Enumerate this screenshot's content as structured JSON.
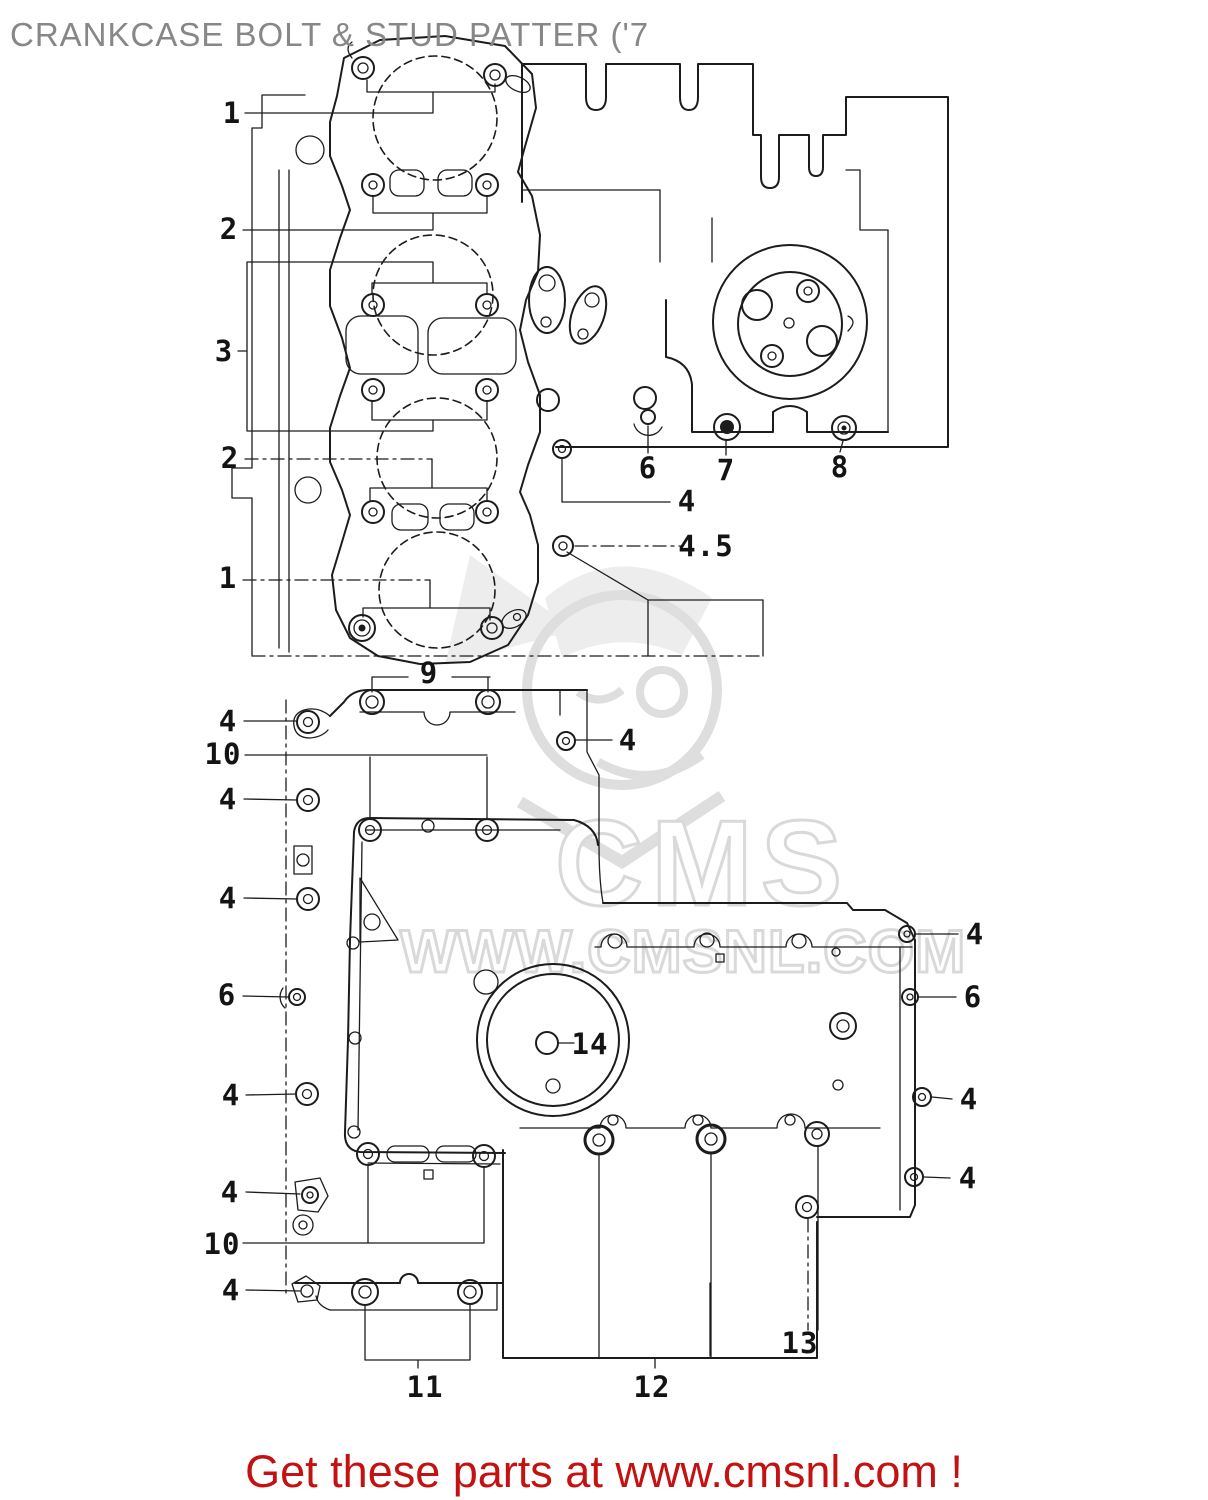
{
  "page": {
    "title": "CRANKCASE BOLT & STUD PATTER ('7",
    "footer": "Get these parts at www.cmsnl.com !",
    "footer_color": "#c41111",
    "title_color": "#878787"
  },
  "watermark": {
    "line1": "CMS",
    "line2": "WWW.CMSNL.COM",
    "color": "#dedede"
  },
  "diagram": {
    "description": "Crankcase bolt and stud pattern exploded parts diagram, upper crankcase (top) and lower crankcase (bottom) views",
    "callouts": [
      {
        "label": "1",
        "x": 232,
        "y": 113
      },
      {
        "label": "2",
        "x": 229,
        "y": 229
      },
      {
        "label": "3",
        "x": 224,
        "y": 351
      },
      {
        "label": "2",
        "x": 230,
        "y": 458
      },
      {
        "label": "1",
        "x": 228,
        "y": 578
      },
      {
        "label": "6",
        "x": 648,
        "y": 468
      },
      {
        "label": "7",
        "x": 726,
        "y": 470
      },
      {
        "label": "8",
        "x": 840,
        "y": 467
      },
      {
        "label": "4",
        "x": 687,
        "y": 501
      },
      {
        "label": "4.5",
        "x": 706,
        "y": 546
      },
      {
        "label": "9",
        "x": 429,
        "y": 673
      },
      {
        "label": "4",
        "x": 228,
        "y": 721
      },
      {
        "label": "10",
        "x": 223,
        "y": 754
      },
      {
        "label": "4",
        "x": 228,
        "y": 799
      },
      {
        "label": "4",
        "x": 228,
        "y": 898
      },
      {
        "label": "6",
        "x": 227,
        "y": 995
      },
      {
        "label": "4",
        "x": 231,
        "y": 1095
      },
      {
        "label": "4",
        "x": 230,
        "y": 1192
      },
      {
        "label": "10",
        "x": 222,
        "y": 1244
      },
      {
        "label": "4",
        "x": 231,
        "y": 1290
      },
      {
        "label": "4",
        "x": 628,
        "y": 740
      },
      {
        "label": "4",
        "x": 975,
        "y": 934
      },
      {
        "label": "6",
        "x": 973,
        "y": 997
      },
      {
        "label": "4",
        "x": 969,
        "y": 1099
      },
      {
        "label": "4",
        "x": 968,
        "y": 1178
      },
      {
        "label": "14",
        "x": 590,
        "y": 1044
      },
      {
        "label": "11",
        "x": 425,
        "y": 1387
      },
      {
        "label": "12",
        "x": 652,
        "y": 1387
      },
      {
        "label": "13",
        "x": 800,
        "y": 1343
      }
    ]
  }
}
